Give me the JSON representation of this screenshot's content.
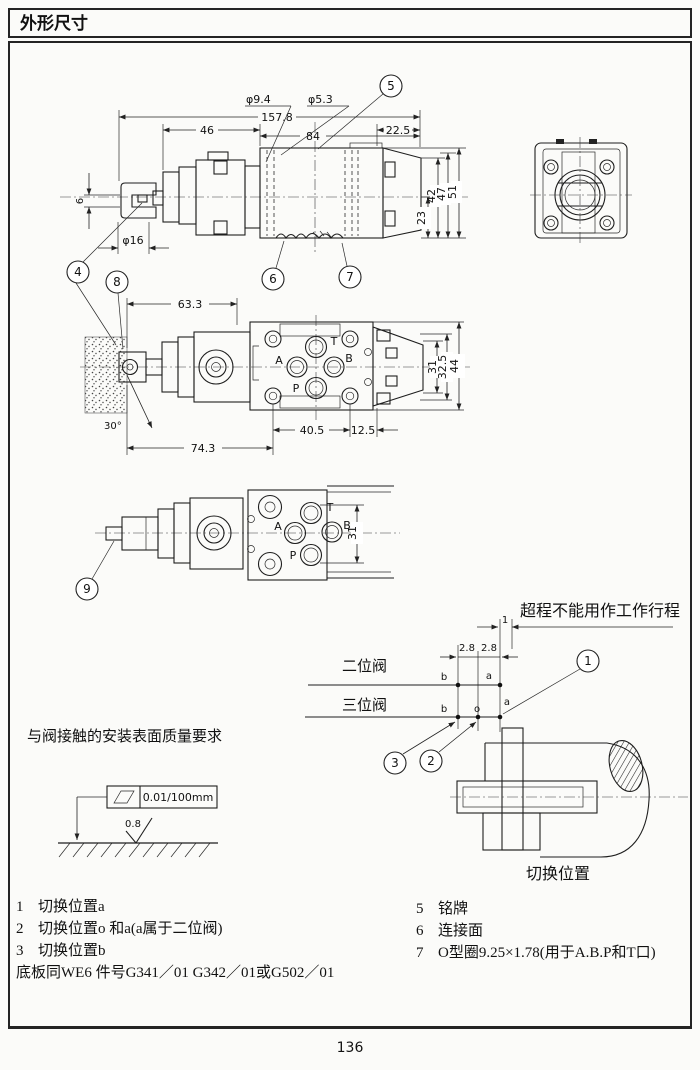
{
  "page": {
    "title": "外形尺寸",
    "page_number": "136"
  },
  "ports": {
    "a": "A",
    "t": "T",
    "b": "B",
    "p": "P"
  },
  "top_view": {
    "dims": {
      "phi_9_4": "φ9.4",
      "phi_5_3": "φ5.3",
      "total": "157.8",
      "left": "46",
      "mid": "84",
      "right": "22.5",
      "h23": "23",
      "h42": "42",
      "h47": "47",
      "h51": "51",
      "slot": "6",
      "phi16": "φ16"
    },
    "callouts": {
      "c4": "4",
      "c5": "5",
      "c6": "6",
      "c7": "7",
      "c8": "8"
    }
  },
  "mid_view": {
    "dims": {
      "d63": "63.3",
      "d74": "74.3",
      "d40": "40.5",
      "d12": "12.5",
      "w31": "31",
      "w32": "32.5",
      "w44": "44",
      "angle": "30°"
    }
  },
  "small_view": {
    "dims": {
      "w31": "31"
    },
    "callouts": {
      "c9": "9"
    }
  },
  "stroke": {
    "note": "超程不能用作工作行程",
    "two_pos": "二位阀",
    "three_pos": "三位阀",
    "dims": {
      "d1": "1",
      "d28l": "2.8",
      "d28r": "2.8"
    },
    "labels": {
      "b2": "b",
      "a2": "a",
      "b3": "b",
      "o3": "o",
      "a3": "a"
    },
    "callouts": {
      "c1": "1",
      "c2": "2",
      "c3": "3"
    },
    "caption": "切换位置"
  },
  "surface": {
    "title": "与阀接触的安装表面质量要求",
    "flatness": "0.01/100mm",
    "roughness": "0.8"
  },
  "legend": {
    "left": [
      {
        "num": "1",
        "text": "切换位置a"
      },
      {
        "num": "2",
        "text": "切换位置o 和a(a属于二位阀)"
      },
      {
        "num": "3",
        "text": "切换位置b"
      }
    ],
    "note": "底板同WE6    件号G341／01    G342／01或G502／01",
    "right": [
      {
        "num": "5",
        "text": "铭牌"
      },
      {
        "num": "6",
        "text": "连接面"
      },
      {
        "num": "7",
        "text": "O型圈9.25×1.78(用于A.B.P和T口)"
      }
    ]
  }
}
